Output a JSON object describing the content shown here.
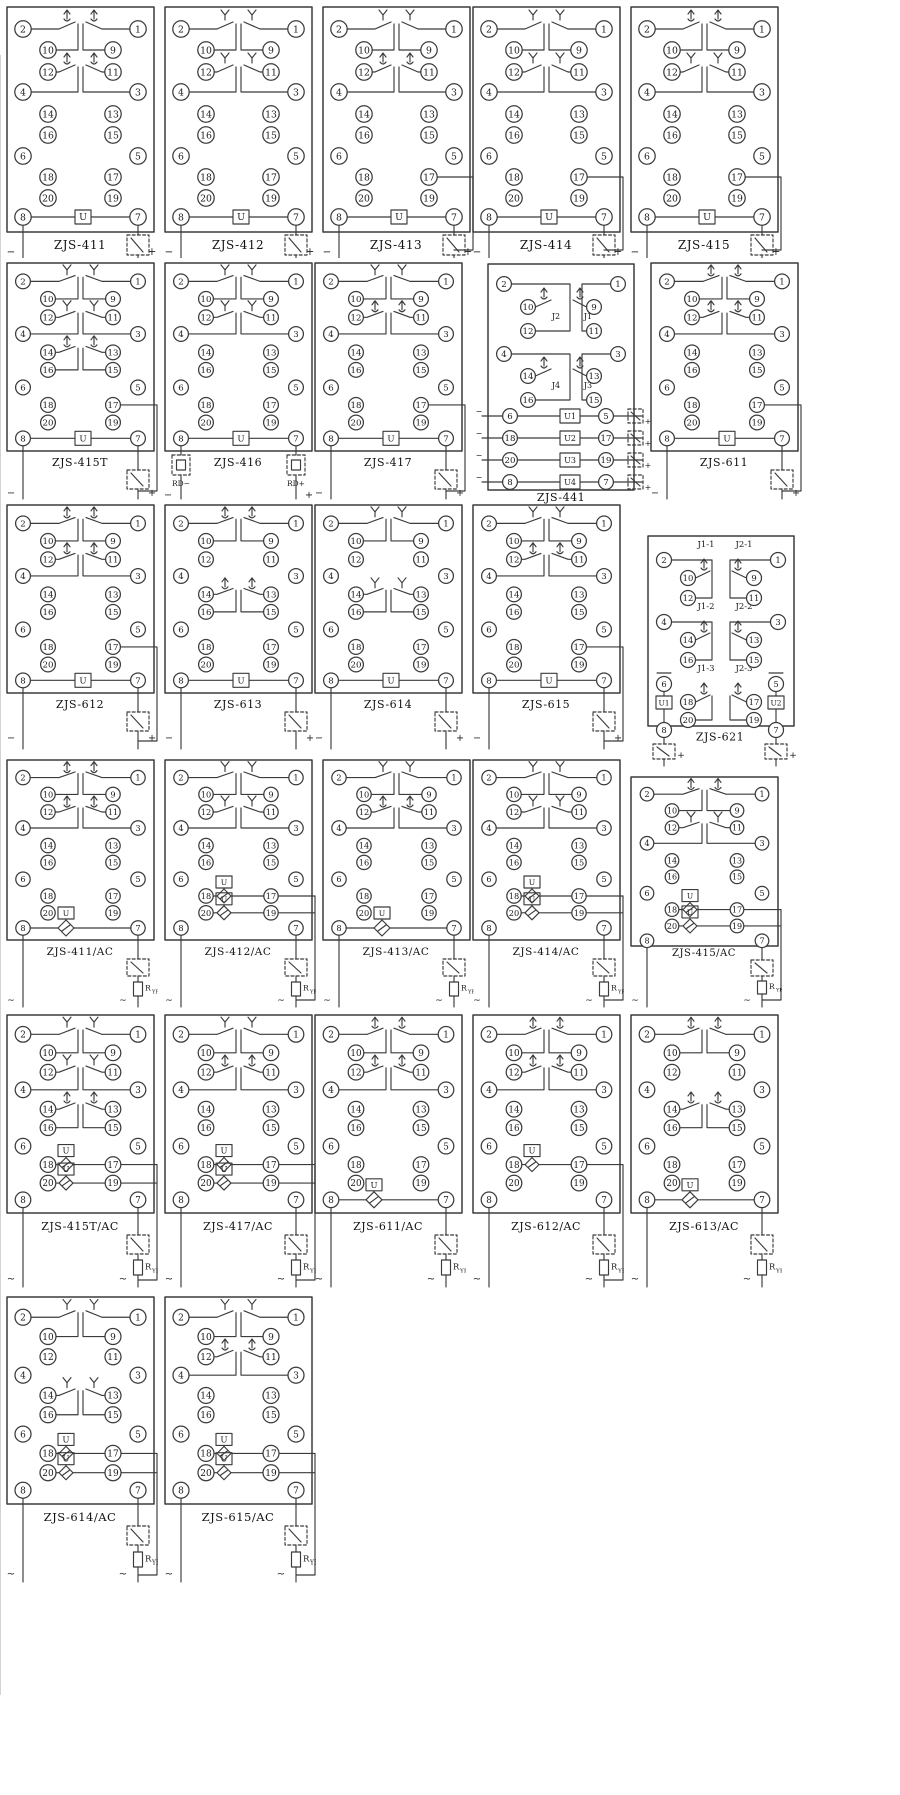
{
  "page": {
    "background": "#ffffff",
    "line_color": "#3b3b3b"
  },
  "shared": {
    "terminals": {
      "left": [
        "2",
        "10",
        "12",
        "4",
        "14",
        "16",
        "6",
        "18",
        "20",
        "8"
      ],
      "right": [
        "1",
        "9",
        "11",
        "3",
        "13",
        "15",
        "5",
        "17",
        "19",
        "7"
      ]
    },
    "symbols": {
      "coil": "U",
      "plus": "+",
      "minus": "−",
      "ac": "~",
      "resistor_main": "R",
      "resistor_sub": "YF"
    }
  },
  "diagrams": [
    {
      "label": "ZJS-411",
      "row": 0,
      "col": 0,
      "kind": "std",
      "ac": false,
      "groups": [
        {
          "pos": 1,
          "style": "arrow"
        },
        {
          "pos": 2,
          "style": "arrow"
        }
      ],
      "coils": [
        {
          "at": "bottom",
          "label": "U",
          "bridge": false
        }
      ],
      "feed": "7",
      "marks": [
        "−",
        "+"
      ]
    },
    {
      "label": "ZJS-412",
      "row": 0,
      "col": 1,
      "kind": "std",
      "ac": false,
      "groups": [
        {
          "pos": 1,
          "style": "fork"
        },
        {
          "pos": 2,
          "style": "fork"
        }
      ],
      "coils": [
        {
          "at": "bottom",
          "label": "U",
          "bridge": false
        }
      ],
      "feed": "7",
      "marks": [
        "−",
        "+"
      ]
    },
    {
      "label": "ZJS-413",
      "row": 0,
      "col": 2,
      "kind": "std",
      "ac": false,
      "groups": [
        {
          "pos": 1,
          "style": "fork"
        },
        {
          "pos": 2,
          "style": "arrow"
        }
      ],
      "coils": [
        {
          "at": "bottom",
          "label": "U",
          "bridge": false
        }
      ],
      "feed": "17",
      "marks": [
        "−",
        "+"
      ]
    },
    {
      "label": "ZJS-414",
      "row": 0,
      "col": 3,
      "kind": "std",
      "ac": false,
      "groups": [
        {
          "pos": 1,
          "style": "fork"
        },
        {
          "pos": 2,
          "style": "fork"
        }
      ],
      "coils": [
        {
          "at": "bottom",
          "label": "U",
          "bridge": false
        }
      ],
      "feed": "17",
      "marks": [
        "−",
        "+"
      ]
    },
    {
      "label": "ZJS-415",
      "row": 0,
      "col": 4,
      "kind": "std",
      "ac": false,
      "groups": [
        {
          "pos": 1,
          "style": "arrow"
        },
        {
          "pos": 2,
          "style": "fork"
        }
      ],
      "coils": [
        {
          "at": "bottom",
          "label": "U",
          "bridge": false
        }
      ],
      "feed": "17",
      "marks": [
        "−",
        "+"
      ]
    },
    {
      "label": "ZJS-415T",
      "row": 1,
      "col": 0,
      "kind": "std",
      "ac": false,
      "groups": [
        {
          "pos": 1,
          "style": "fork"
        },
        {
          "pos": 2,
          "style": "fork"
        },
        {
          "pos": 3,
          "style": "arrow"
        }
      ],
      "coils": [
        {
          "at": "bottom",
          "label": "U",
          "bridge": false
        }
      ],
      "feed": "17",
      "marks": [
        "−",
        "+"
      ]
    },
    {
      "label": "ZJS-416",
      "row": 1,
      "col": 1,
      "kind": "std",
      "ac": false,
      "groups": [
        {
          "pos": 1,
          "style": "fork"
        },
        {
          "pos": 2,
          "style": "fork"
        }
      ],
      "coils": [
        {
          "at": "bottom",
          "label": "U",
          "bridge": false
        }
      ],
      "feed": "fuse",
      "fuse_labels": [
        "RD−",
        "RD+"
      ],
      "marks": [
        "−",
        "+"
      ]
    },
    {
      "label": "ZJS-417",
      "row": 1,
      "col": 2,
      "kind": "std",
      "ac": false,
      "groups": [
        {
          "pos": 1,
          "style": "fork"
        },
        {
          "pos": 2,
          "style": "arrow"
        }
      ],
      "coils": [
        {
          "at": "bottom",
          "label": "U",
          "bridge": false
        }
      ],
      "feed": "17",
      "marks": [
        "−",
        "+"
      ]
    },
    {
      "label": "ZJS-441",
      "row": 1,
      "col": 3,
      "kind": "q441",
      "ac": false,
      "contact_labels": [
        "J2",
        "J1",
        "J4",
        "J3"
      ],
      "coils": [
        {
          "label": "U1"
        },
        {
          "label": "U2"
        },
        {
          "label": "U3"
        },
        {
          "label": "U4"
        }
      ],
      "marks": [
        "−",
        "+"
      ]
    },
    {
      "label": "ZJS-611",
      "row": 1,
      "col": 4,
      "kind": "std",
      "ac": false,
      "groups": [
        {
          "pos": 1,
          "style": "arrow"
        },
        {
          "pos": 2,
          "style": "arrow"
        }
      ],
      "coils": [
        {
          "at": "bottom",
          "label": "U",
          "bridge": false
        }
      ],
      "feed": "17",
      "marks": [
        "−",
        "+"
      ]
    },
    {
      "label": "ZJS-612",
      "row": 2,
      "col": 0,
      "kind": "std",
      "ac": false,
      "groups": [
        {
          "pos": 1,
          "style": "arrow"
        },
        {
          "pos": 2,
          "style": "arrow"
        }
      ],
      "coils": [
        {
          "at": "bottom",
          "label": "U",
          "bridge": false
        }
      ],
      "feed": "17",
      "marks": [
        "−",
        "+"
      ]
    },
    {
      "label": "ZJS-613",
      "row": 2,
      "col": 1,
      "kind": "std",
      "ac": false,
      "groups": [
        {
          "pos": 1,
          "style": "arrow"
        },
        {
          "pos": 3,
          "style": "arrow"
        }
      ],
      "coils": [
        {
          "at": "bottom",
          "label": "U",
          "bridge": false
        }
      ],
      "feed": "7",
      "marks": [
        "−",
        "+"
      ]
    },
    {
      "label": "ZJS-614",
      "row": 2,
      "col": 2,
      "kind": "std",
      "ac": false,
      "groups": [
        {
          "pos": 1,
          "style": "fork"
        },
        {
          "pos": 3,
          "style": "fork"
        }
      ],
      "coils": [
        {
          "at": "bottom",
          "label": "U",
          "bridge": false
        }
      ],
      "feed": "7",
      "marks": [
        "−",
        "+"
      ]
    },
    {
      "label": "ZJS-615",
      "row": 2,
      "col": 3,
      "kind": "std",
      "ac": false,
      "groups": [
        {
          "pos": 1,
          "style": "fork"
        },
        {
          "pos": 2,
          "style": "arrow"
        }
      ],
      "coils": [
        {
          "at": "bottom",
          "label": "U",
          "bridge": false
        }
      ],
      "feed": "17",
      "marks": [
        "−",
        "+"
      ]
    },
    {
      "label": "ZJS-621",
      "row": 2,
      "col": 4,
      "kind": "dual621",
      "ac": false,
      "group_labels": [
        "J1-1",
        "J2-1",
        "J1-2",
        "J2-2",
        "J1-3",
        "J2-3"
      ],
      "coils": [
        {
          "label": "U1"
        },
        {
          "label": "U2"
        }
      ],
      "marks": [
        "+",
        "+"
      ]
    },
    {
      "label": "ZJS-411/AC",
      "row": 3,
      "col": 0,
      "kind": "std",
      "ac": true,
      "groups": [
        {
          "pos": 1,
          "style": "arrow"
        },
        {
          "pos": 2,
          "style": "arrow"
        }
      ],
      "coils": [
        {
          "at": "bottom",
          "label": "U",
          "bridge": true
        }
      ],
      "feed": "7",
      "marks": [
        "~",
        "~"
      ]
    },
    {
      "label": "ZJS-412/AC",
      "row": 3,
      "col": 1,
      "kind": "std",
      "ac": true,
      "groups": [
        {
          "pos": 1,
          "style": "fork"
        },
        {
          "pos": 2,
          "style": "fork"
        }
      ],
      "coils": [
        {
          "at": "r17",
          "label": "U",
          "bridge": true
        },
        {
          "at": "r19",
          "label": "U",
          "bridge": true
        }
      ],
      "feed": "edge",
      "marks": [
        "~",
        "~"
      ]
    },
    {
      "label": "ZJS-413/AC",
      "row": 3,
      "col": 2,
      "kind": "std",
      "ac": true,
      "groups": [
        {
          "pos": 1,
          "style": "fork"
        },
        {
          "pos": 2,
          "style": "arrow"
        }
      ],
      "coils": [
        {
          "at": "bottom",
          "label": "U",
          "bridge": true
        }
      ],
      "feed": "7",
      "marks": [
        "~",
        "~"
      ]
    },
    {
      "label": "ZJS-414/AC",
      "row": 3,
      "col": 3,
      "kind": "std",
      "ac": true,
      "groups": [
        {
          "pos": 1,
          "style": "fork"
        },
        {
          "pos": 2,
          "style": "fork"
        }
      ],
      "coils": [
        {
          "at": "r17",
          "label": "U",
          "bridge": true
        },
        {
          "at": "r19",
          "label": "U",
          "bridge": true
        }
      ],
      "feed": "edge",
      "marks": [
        "~",
        "~"
      ]
    },
    {
      "label": "ZJS-415/AC",
      "row": 3,
      "col": 4,
      "kind": "std",
      "ac": true,
      "groups": [
        {
          "pos": 1,
          "style": "arrow"
        },
        {
          "pos": 2,
          "style": "fork"
        }
      ],
      "coils": [
        {
          "at": "r17",
          "label": "U",
          "bridge": true
        },
        {
          "at": "r19",
          "label": "U",
          "bridge": true
        }
      ],
      "feed": "edge",
      "marks": [
        "~",
        "~"
      ]
    },
    {
      "label": "ZJS-415T/AC",
      "row": 4,
      "col": 0,
      "kind": "std",
      "ac": true,
      "groups": [
        {
          "pos": 1,
          "style": "fork"
        },
        {
          "pos": 2,
          "style": "fork"
        },
        {
          "pos": 3,
          "style": "arrow"
        }
      ],
      "coils": [
        {
          "at": "r17",
          "label": "U",
          "bridge": true
        },
        {
          "at": "r19",
          "label": "U",
          "bridge": true
        }
      ],
      "feed": "edge",
      "marks": [
        "~",
        "~"
      ]
    },
    {
      "label": "ZJS-417/AC",
      "row": 4,
      "col": 1,
      "kind": "std",
      "ac": true,
      "groups": [
        {
          "pos": 1,
          "style": "fork"
        },
        {
          "pos": 2,
          "style": "arrow"
        }
      ],
      "coils": [
        {
          "at": "r17",
          "label": "U",
          "bridge": true
        },
        {
          "at": "r19",
          "label": "U",
          "bridge": true
        }
      ],
      "feed": "edge",
      "marks": [
        "~",
        "~"
      ]
    },
    {
      "label": "ZJS-611/AC",
      "row": 4,
      "col": 2,
      "kind": "std",
      "ac": true,
      "groups": [
        {
          "pos": 1,
          "style": "arrow"
        },
        {
          "pos": 2,
          "style": "arrow"
        }
      ],
      "coils": [
        {
          "at": "bottom",
          "label": "U",
          "bridge": true
        }
      ],
      "feed": "7",
      "marks": [
        "~",
        "~"
      ]
    },
    {
      "label": "ZJS-612/AC",
      "row": 4,
      "col": 3,
      "kind": "std",
      "ac": true,
      "groups": [
        {
          "pos": 1,
          "style": "arrow"
        },
        {
          "pos": 2,
          "style": "arrow"
        }
      ],
      "coils": [
        {
          "at": "r17",
          "label": "U",
          "bridge": true
        }
      ],
      "feed": "edge",
      "marks": [
        "~",
        "~"
      ]
    },
    {
      "label": "ZJS-613/AC",
      "row": 4,
      "col": 4,
      "kind": "std",
      "ac": true,
      "groups": [
        {
          "pos": 1,
          "style": "arrow"
        },
        {
          "pos": 3,
          "style": "arrow"
        }
      ],
      "coils": [
        {
          "at": "bottom",
          "label": "U",
          "bridge": true
        }
      ],
      "feed": "7",
      "marks": [
        "~",
        "~"
      ]
    },
    {
      "label": "ZJS-614/AC",
      "row": 5,
      "col": 0,
      "kind": "std",
      "ac": true,
      "groups": [
        {
          "pos": 1,
          "style": "fork"
        },
        {
          "pos": 3,
          "style": "fork"
        }
      ],
      "coils": [
        {
          "at": "r17",
          "label": "U",
          "bridge": true
        },
        {
          "at": "r19",
          "label": "U",
          "bridge": true
        }
      ],
      "feed": "edge",
      "marks": [
        "~",
        "~"
      ]
    },
    {
      "label": "ZJS-615/AC",
      "row": 5,
      "col": 1,
      "kind": "std",
      "ac": true,
      "groups": [
        {
          "pos": 1,
          "style": "fork"
        },
        {
          "pos": 2,
          "style": "arrow"
        }
      ],
      "coils": [
        {
          "at": "r17",
          "label": "U",
          "bridge": true
        },
        {
          "at": "r19",
          "label": "U",
          "bridge": true
        }
      ],
      "feed": "edge",
      "marks": [
        "~",
        "~"
      ]
    }
  ]
}
